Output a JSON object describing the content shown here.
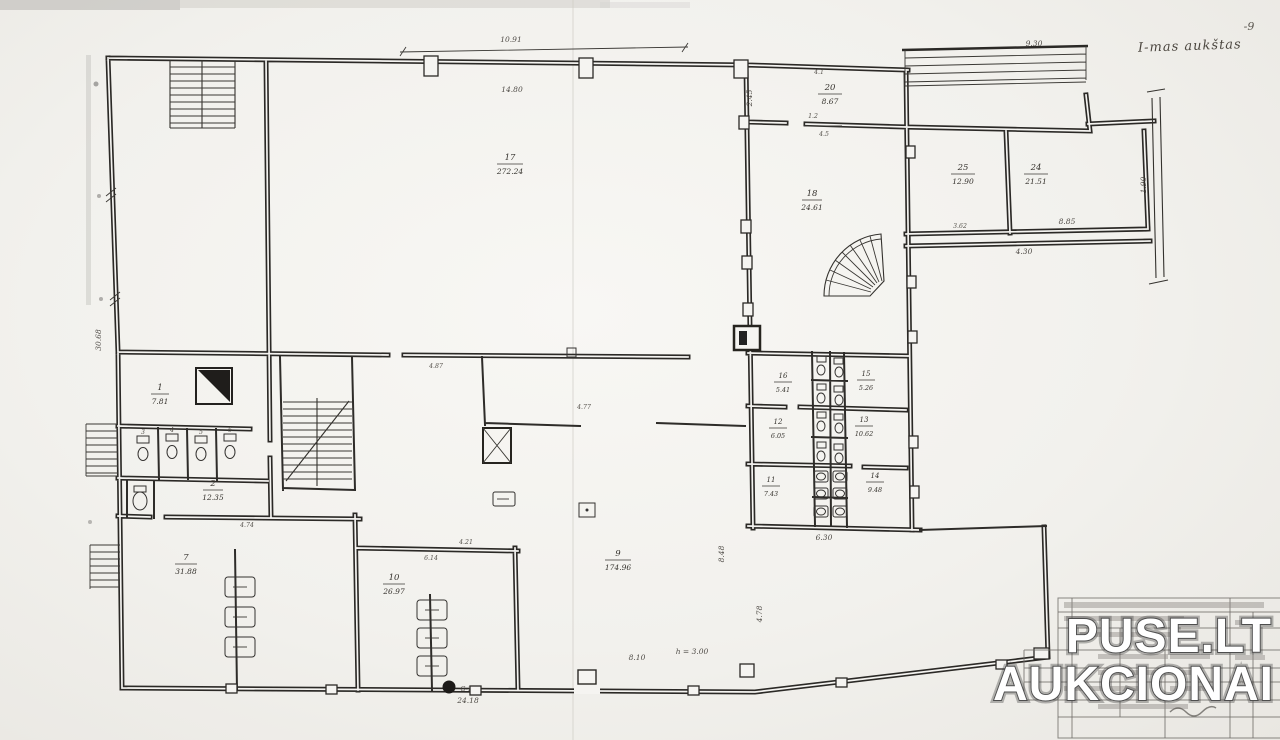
{
  "plan": {
    "annotations": {
      "floor_note": "I-mas aukštas",
      "page_mark": "-9"
    },
    "rooms": {
      "r1": {
        "number": "1",
        "area": "7.81"
      },
      "r2": {
        "number": "2",
        "area": "12.35"
      },
      "r7": {
        "number": "7",
        "area": "31.88"
      },
      "r9": {
        "number": "9",
        "area": "174.96"
      },
      "r10": {
        "number": "10",
        "area": "26.97"
      },
      "r11": {
        "number": "11",
        "area": "7.43"
      },
      "r12": {
        "number": "12",
        "area": "6.05"
      },
      "r13": {
        "number": "13",
        "area": "10.62"
      },
      "r14": {
        "number": "14",
        "area": "9.48"
      },
      "r15": {
        "number": "15",
        "area": "5.26"
      },
      "r16": {
        "number": "16",
        "area": "5.41"
      },
      "r17": {
        "number": "17",
        "area": "272.24"
      },
      "r18": {
        "number": "18",
        "area": "24.61"
      },
      "r20": {
        "number": "20",
        "area": "8.67"
      },
      "r24": {
        "number": "24",
        "area": "21.51"
      },
      "r25": {
        "number": "25",
        "area": "12.90"
      }
    },
    "stalls": {
      "s3": "3",
      "s4": "4",
      "s5": "5",
      "s6": "6"
    },
    "dimensions": {
      "top_hall_width": "10.91",
      "hall_inner_width": "14.80",
      "ramp_length": "9.30",
      "east_wing_depth": "2.45",
      "top_small_a": "4.1",
      "top_small_b": "1.2",
      "top_small_c": "4.5",
      "annex_small": "3.62",
      "annex_width": "8.85",
      "annex_offset": "4.30",
      "yard_wall": "1.90",
      "west_length": "30.68",
      "grid_width": "6.30",
      "bottom_opening": "8.10",
      "bottom_length": "24.18",
      "hall_door": "4.87",
      "mid_opening": "4.77",
      "room7_top": "4.74",
      "room10_top_a": "4.21",
      "room10_top_b": "6.14",
      "grid_side_a": "8.48",
      "grid_side_b": "4.78"
    },
    "markers": {
      "section_cut": "G-1",
      "level_note": "h = 3.00"
    }
  },
  "watermark": {
    "line1": "PUSE.LT",
    "line2": "AUKCIONAI"
  },
  "colors": {
    "ink": "#2b2926",
    "paper": "#f3f2ef",
    "watermark_fill": "#ffffff",
    "watermark_outline": "#4e4e4e"
  }
}
